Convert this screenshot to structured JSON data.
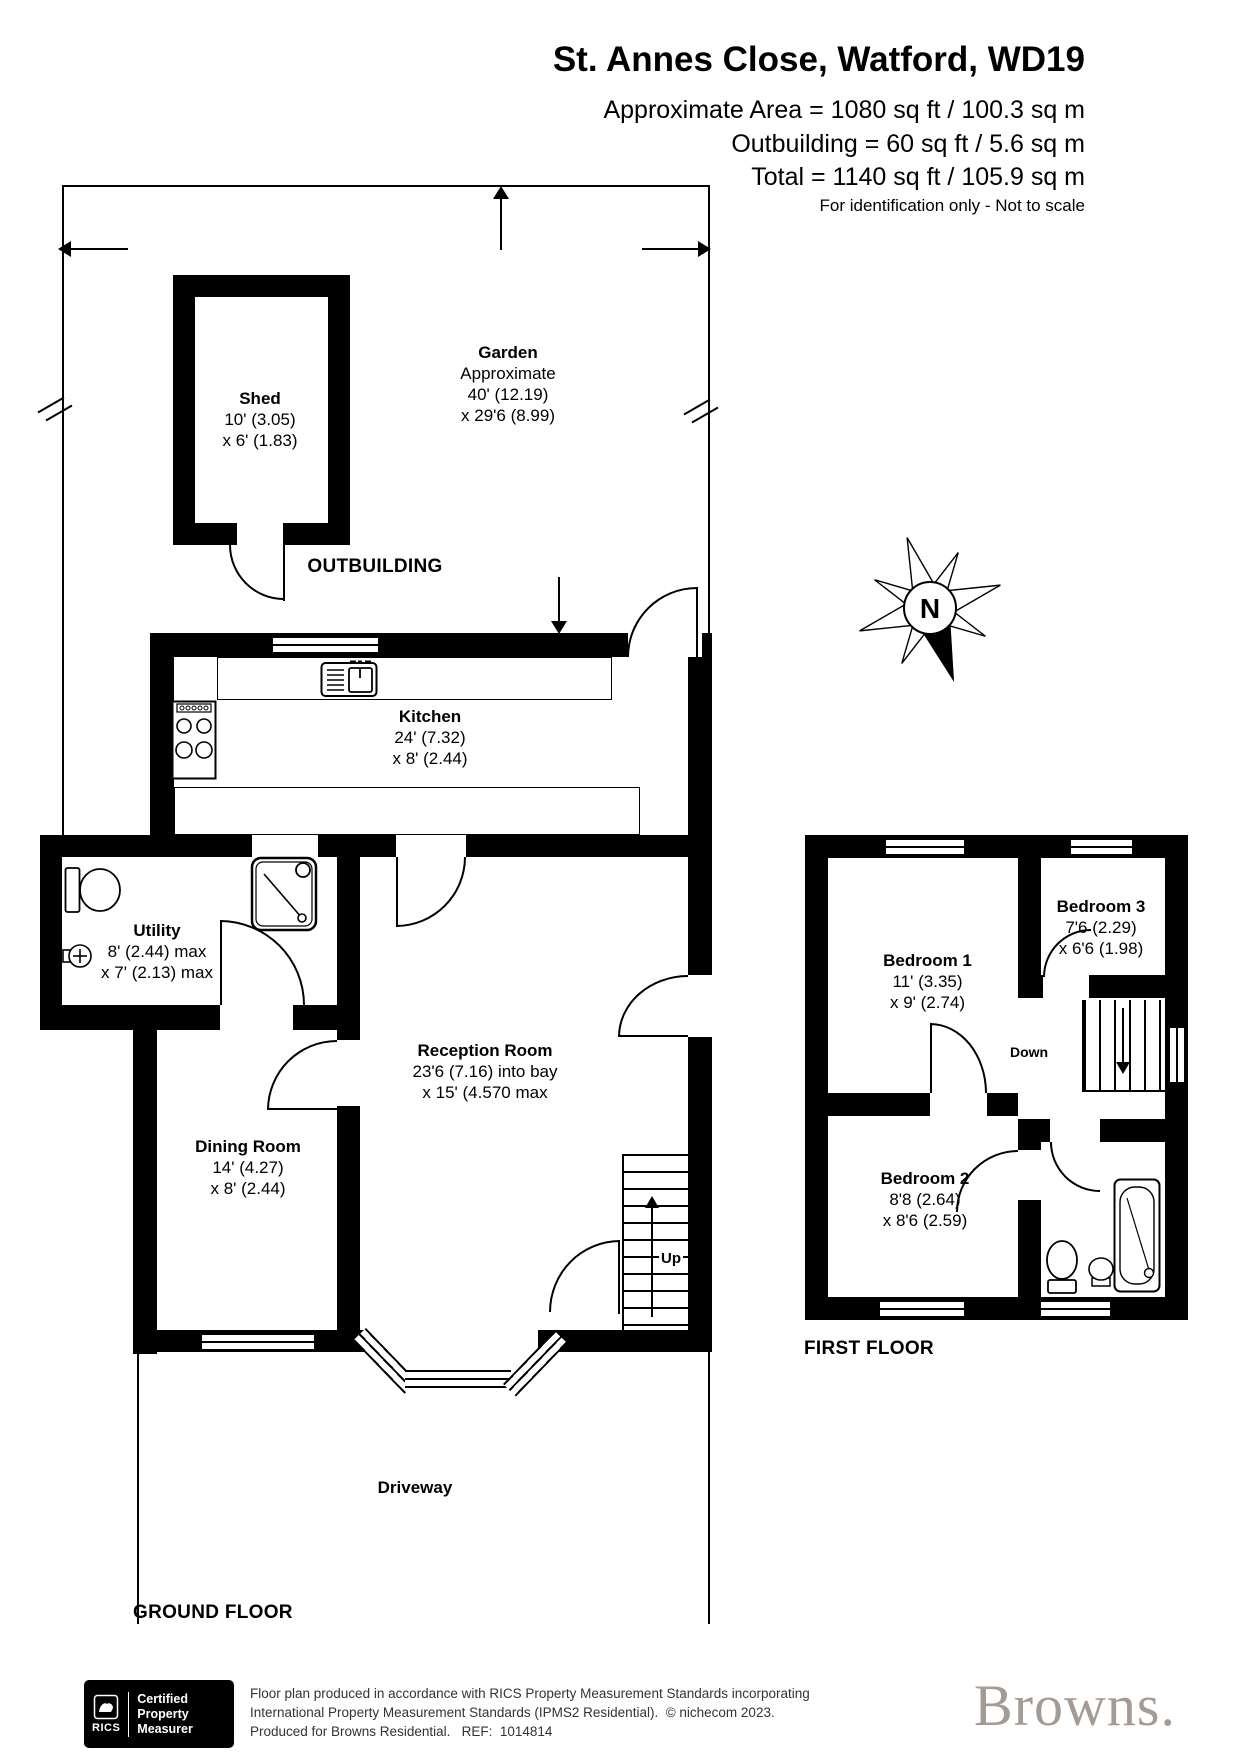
{
  "header": {
    "title": "St. Annes Close, Watford, WD19",
    "area1": "Approximate Area = 1080 sq ft / 100.3 sq m",
    "area2": "Outbuilding = 60 sq ft / 5.6 sq m",
    "area3": "Total = 1140 sq ft / 105.9 sq m",
    "note": "For identification only - Not to scale"
  },
  "gf": {
    "label": "GROUND FLOOR",
    "outbuilding": "OUTBUILDING",
    "driveway": "Driveway",
    "up": "Up",
    "garden": {
      "name": "Garden",
      "l1": "Approximate",
      "l2": "40' (12.19)",
      "l3": "x 29'6 (8.99)"
    },
    "shed": {
      "name": "Shed",
      "d1": "10' (3.05)",
      "d2": "x 6' (1.83)"
    },
    "kitchen": {
      "name": "Kitchen",
      "d1": "24' (7.32)",
      "d2": "x 8' (2.44)"
    },
    "utility": {
      "name": "Utility",
      "d1": "8' (2.44) max",
      "d2": "x 7' (2.13) max"
    },
    "reception": {
      "name": "Reception Room",
      "d1": "23'6 (7.16) into bay",
      "d2": "x 15' (4.570 max"
    },
    "dining": {
      "name": "Dining Room",
      "d1": "14' (4.27)",
      "d2": "x 8' (2.44)"
    }
  },
  "ff": {
    "label": "FIRST FLOOR",
    "down": "Down",
    "bed1": {
      "name": "Bedroom 1",
      "d1": "11' (3.35)",
      "d2": "x 9' (2.74)"
    },
    "bed2": {
      "name": "Bedroom 2",
      "d1": "8'8 (2.64)",
      "d2": "x 8'6 (2.59)"
    },
    "bed3": {
      "name": "Bedroom 3",
      "d1": "7'6 (2.29)",
      "d2": "x 6'6 (1.98)"
    }
  },
  "compass": {
    "n": "N"
  },
  "footer": {
    "rics": {
      "org": "RICS",
      "l1": "Certified",
      "l2": "Property",
      "l3": "Measurer"
    },
    "d1": "Floor plan produced in accordance with RICS Property Measurement Standards incorporating",
    "d2": "International Property Measurement Standards (IPMS2 Residential).  © nichecom 2023.",
    "d3": "Produced for Browns Residential.   REF:  1014814",
    "brand": "Browns."
  },
  "colors": {
    "wall": "#000000",
    "brand": "#a49b95"
  }
}
